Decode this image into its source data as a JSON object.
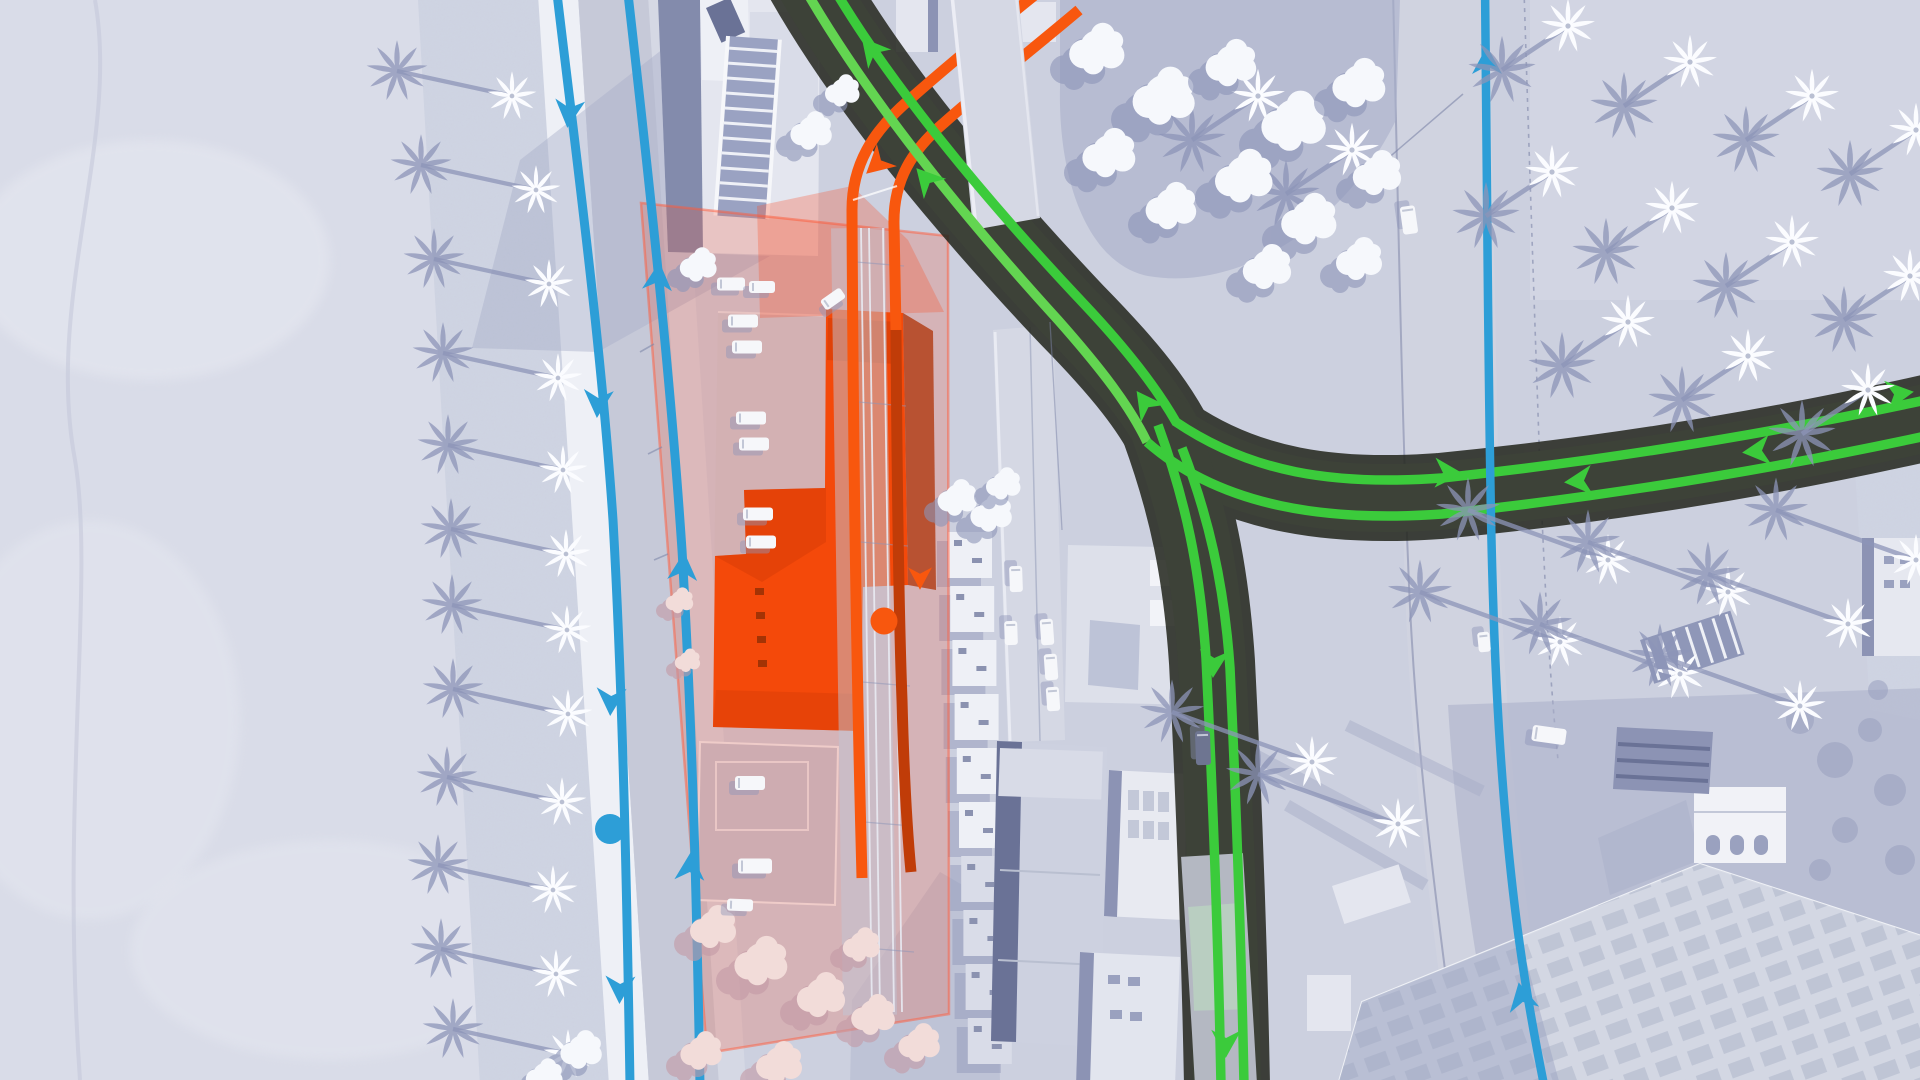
{
  "scene": {
    "view": "top-down city transit route overlay",
    "weather_look": "snow-covered desert city with palm trees",
    "selected_building_highlighted": true,
    "hud_text_visible": false
  },
  "palette": {
    "snow-base": "#d9dce8",
    "snow-bright": "#e8eaf2",
    "snow-bank": "#cfd4e2",
    "ground": "#ccd0df",
    "shadow": "#8d95b8",
    "soft-shadow": "#a9afc9",
    "road-grey": "#c6c9d8",
    "sidewalk": "#eef0f6",
    "walk2": "#d5d8e4",
    "dark-road": "#3d4238",
    "dark-road-edge": "#22251c",
    "bldg": "#e4e6ef",
    "bldg-face": "#8c93b4",
    "bldg-dark": "#6a7296",
    "blue": "#2d9ed7",
    "green": "#3bcb3b",
    "green-light": "#63d551",
    "orange": "#f8570e",
    "orange-dark": "#c03c08",
    "sel": "#f4490a",
    "sel-dark": "#cf3a05",
    "track": "#e9ebf3",
    "car": "#f6f7fa",
    "overlay": "rgba(247,76,43,0.22)",
    "overlay-strong": "rgba(248,84,48,0.30)"
  },
  "routes": {
    "blue": {
      "color": "#2d9ed7",
      "parallel_lines_left_street": 2,
      "extra_line_right_road": 1,
      "stop_circles": 1,
      "direction_arrows": 9
    },
    "green": {
      "color": "#3bcb3b",
      "junction_type": "three-way Y",
      "direction_arrows": 9
    },
    "orange": {
      "color": "#f8570e",
      "shaded_color": "#c03c08",
      "stop_circles": 1,
      "direction_arrows": 2,
      "passes_under_street": true
    }
  },
  "selection": {
    "building_highlight_color": "#f4490a",
    "range_overlay_color": "rgba(247,76,43,0.22)"
  }
}
